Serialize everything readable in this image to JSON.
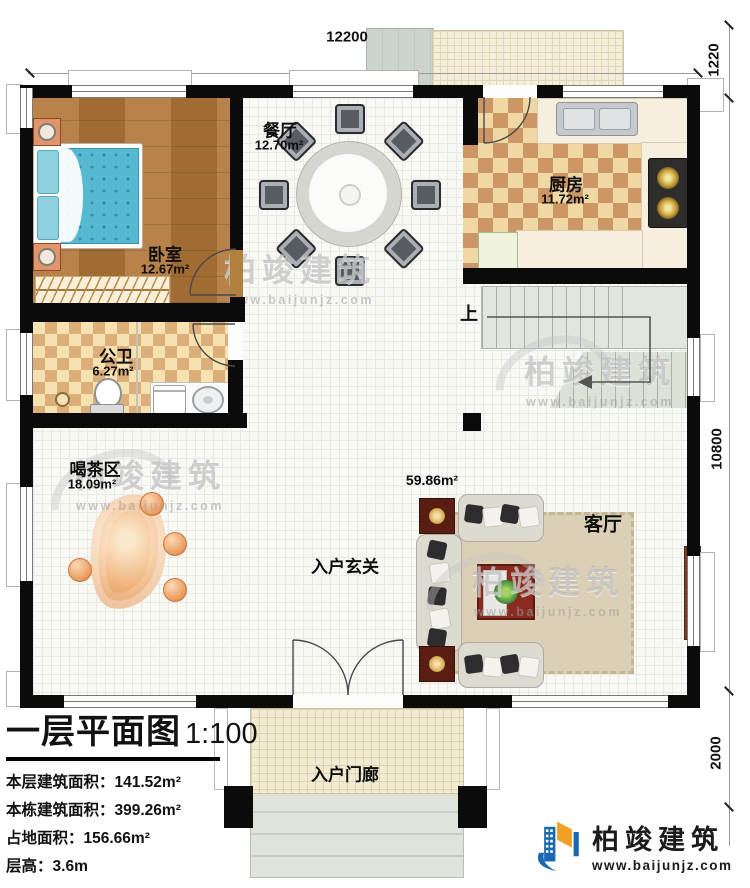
{
  "plan": {
    "title": "一层平面图",
    "scale": "1:100",
    "stats": [
      {
        "label": "本层建筑面积：",
        "value": "141.52m²"
      },
      {
        "label": "本栋建筑面积：",
        "value": "399.26m²"
      },
      {
        "label": "占地面积：",
        "value": "156.66m²"
      },
      {
        "label": "层高：",
        "value": "3.6m"
      }
    ]
  },
  "dimensions": {
    "top": "12200",
    "right_top": "1220",
    "right_middle": "10800",
    "right_bottom": "2000"
  },
  "rooms": {
    "bedroom": {
      "name": "卧室",
      "area": "12.67m²"
    },
    "dining": {
      "name": "餐厅",
      "area": "12.70m²"
    },
    "kitchen": {
      "name": "厨房",
      "area": "11.72m²"
    },
    "bathroom": {
      "name": "公卫",
      "area": "6.27m²"
    },
    "tea_area": {
      "name": "喝茶区",
      "area": "18.09m²"
    },
    "foyer": {
      "name": "入户玄关",
      "area": "59.86m²"
    },
    "living": {
      "name": "客厅"
    },
    "porch": {
      "name": "入户门廊"
    },
    "stairs": {
      "direction_label": "上"
    }
  },
  "watermark": {
    "brand": "柏竣建筑",
    "url": "www.baijunjz.com"
  },
  "logo": {
    "brand": "柏竣建筑",
    "url": "www.baijunjz.com",
    "blue": "#1a6ab2",
    "orange": "#f2a024"
  }
}
